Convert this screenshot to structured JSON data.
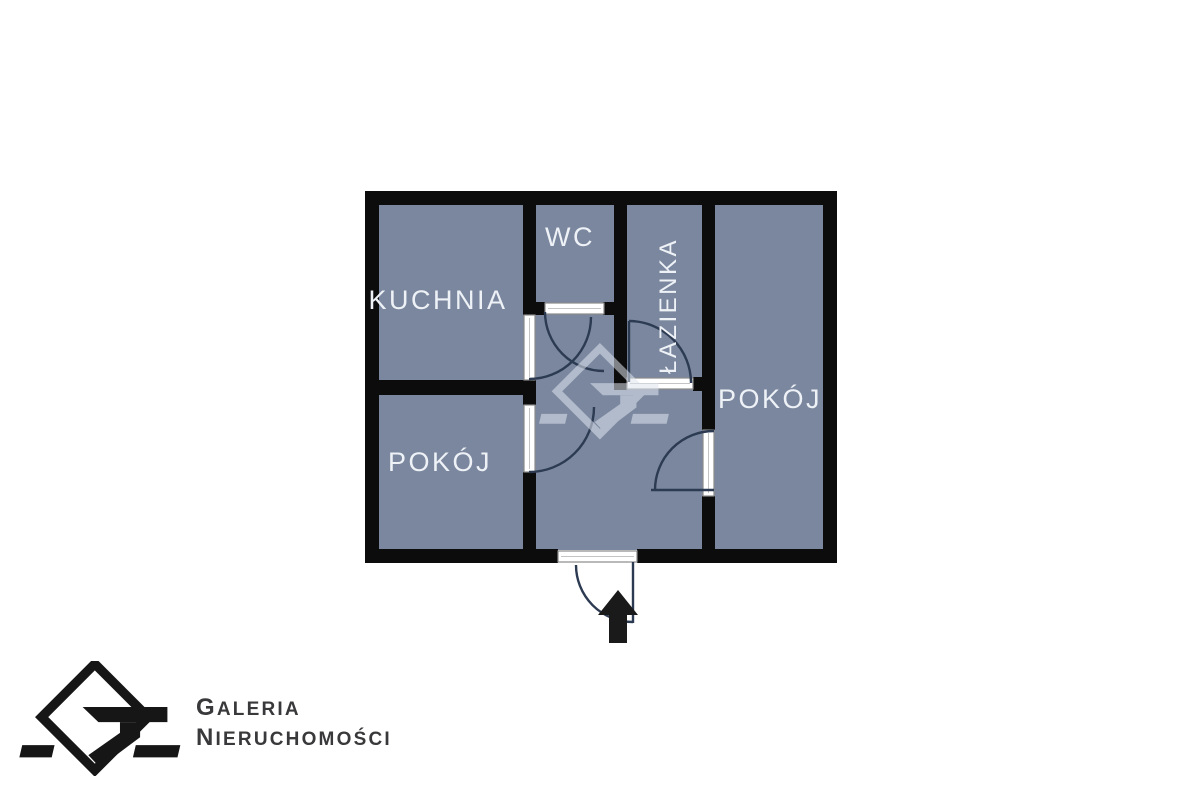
{
  "floor_plan": {
    "rooms": [
      {
        "id": "kuchnia",
        "label": "KUCHNIA"
      },
      {
        "id": "wc",
        "label": "WC"
      },
      {
        "id": "lazienka",
        "label": "ŁAZIENKA"
      },
      {
        "id": "pokoj_left",
        "label": "POKÓJ"
      },
      {
        "id": "pokoj_right",
        "label": "POKÓJ"
      }
    ],
    "icons": [
      {
        "name": "entrance-arrow-icon",
        "meaning": "entrance direction arrow"
      },
      {
        "name": "watermark-logo-icon",
        "meaning": "agency watermark logo"
      }
    ],
    "colors": {
      "room_fill": "#7a879e",
      "wall": "#0c0c0c",
      "door_frame": "#ffffff",
      "door_frame_border": "#8a8a8a",
      "door_swing": "#2c3a52",
      "room_label": "#eef2f7",
      "watermark": "#dfe6f0",
      "background": "#ffffff"
    }
  },
  "branding": {
    "line1": "GALERIA",
    "line2": "NIERUCHOMOŚCI",
    "text_color": "#39393b",
    "logo_color": "#161616"
  }
}
